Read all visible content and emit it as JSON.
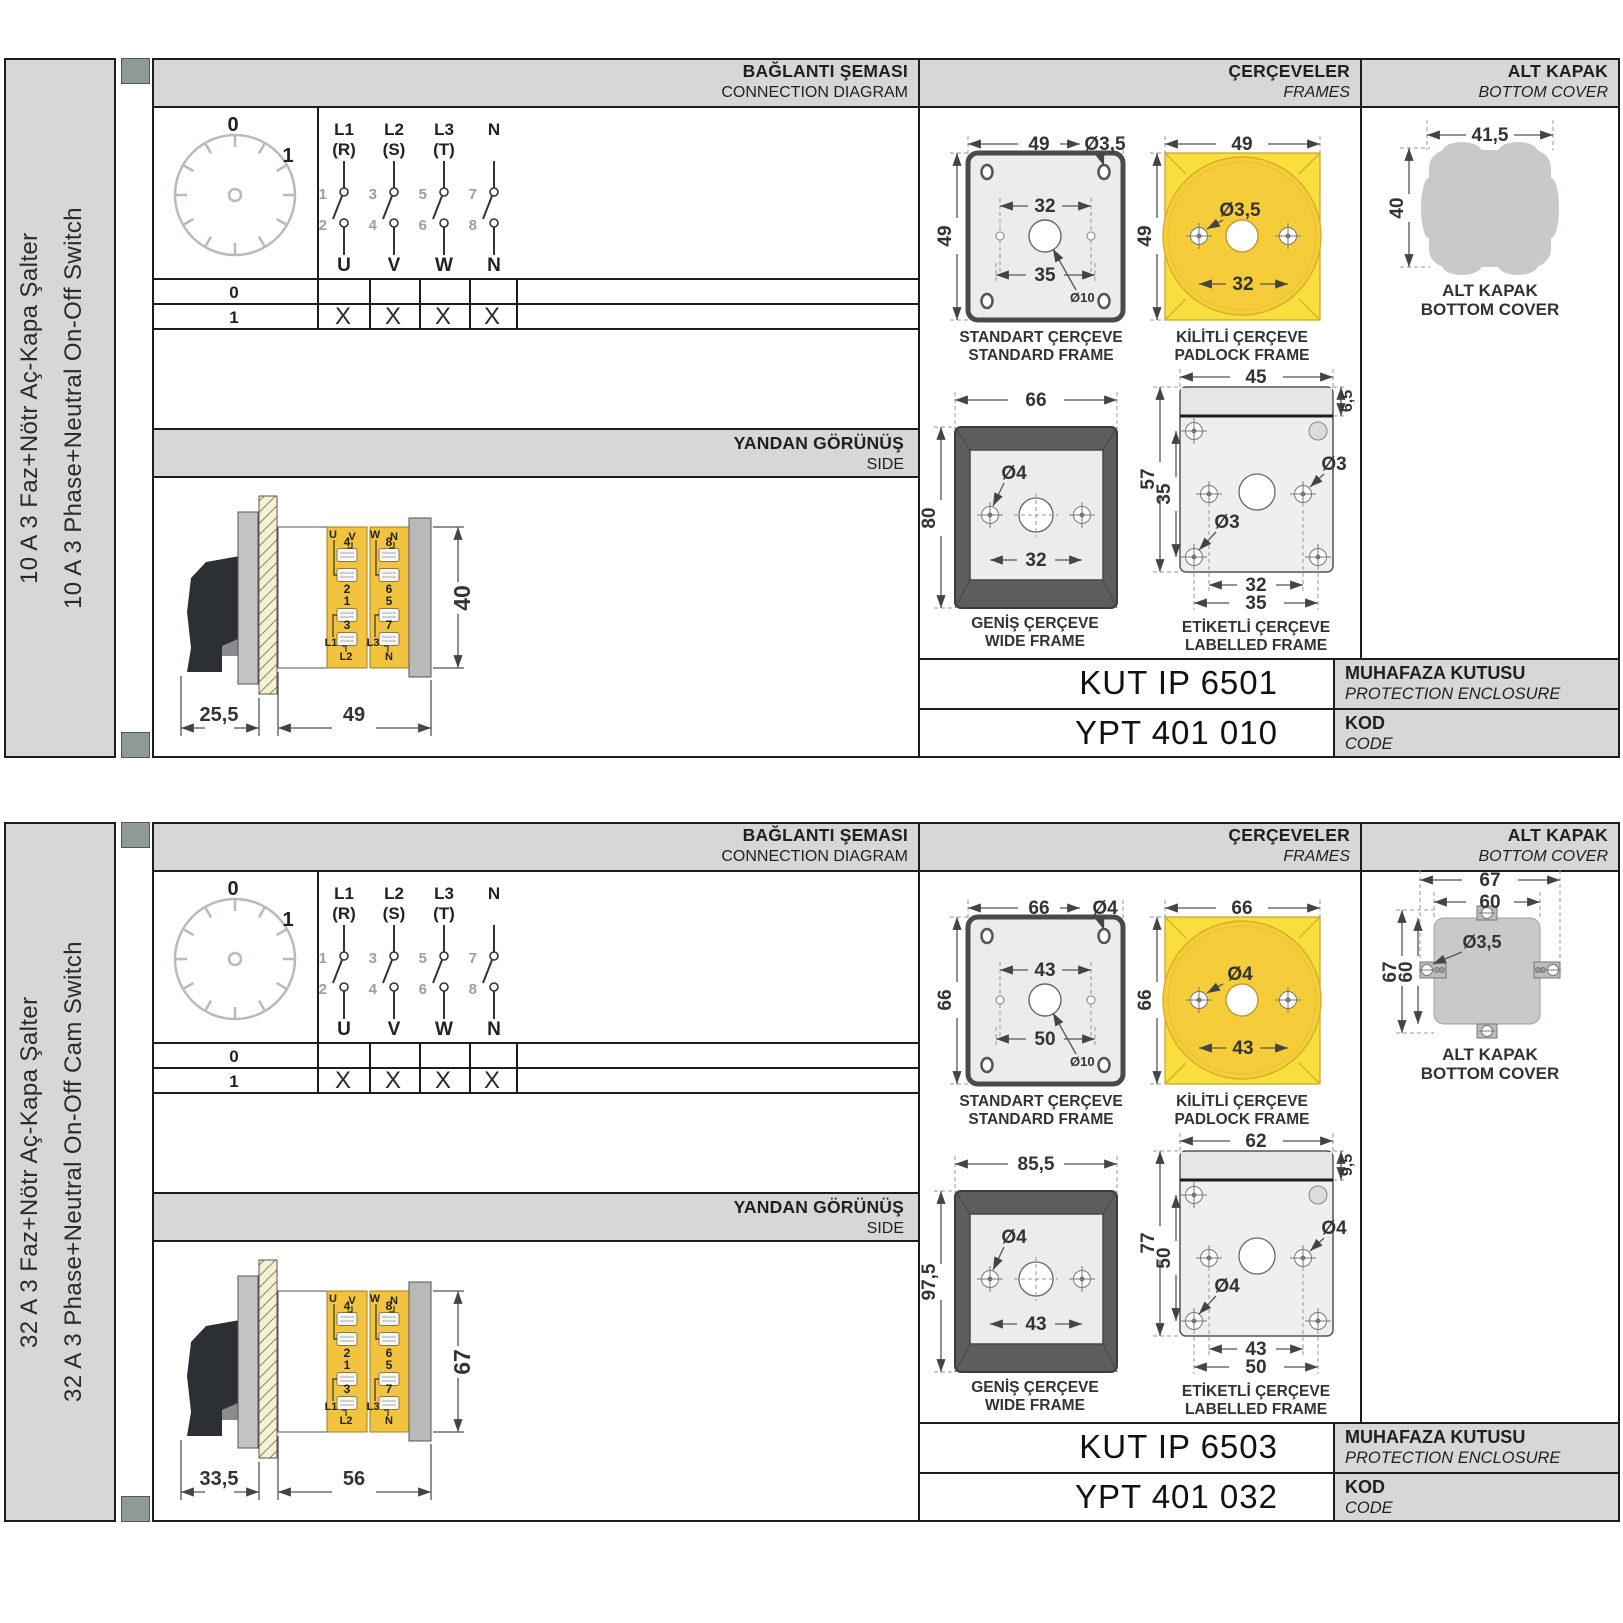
{
  "sections": [
    {
      "sidebar": {
        "tr": "10 A 3 Faz+Nötr Aç-Kapa Şalter",
        "en": "10 A 3 Phase+Neutral On-Off Switch"
      },
      "header": {
        "conn_tr": "BAĞLANTI ŞEMASI",
        "conn_en": "CONNECTION DIAGRAM",
        "frames_tr": "ÇERÇEVELER",
        "frames_en": "FRAMES",
        "cover_tr": "ALT KAPAK",
        "cover_en": "BOTTOM COVER"
      },
      "dial": {
        "pos0": "0",
        "pos1": "1"
      },
      "poles": [
        {
          "line1": "L1",
          "line2": "(R)",
          "n_in": "1",
          "n_out": "2",
          "out": "U"
        },
        {
          "line1": "L2",
          "line2": "(S)",
          "n_in": "3",
          "n_out": "4",
          "out": "V"
        },
        {
          "line1": "L3",
          "line2": "(T)",
          "n_in": "5",
          "n_out": "6",
          "out": "W"
        },
        {
          "line1": "N",
          "line2": "",
          "n_in": "7",
          "n_out": "8",
          "out": "N"
        }
      ],
      "table": {
        "row0": "0",
        "row1": "1",
        "marks": [
          "X",
          "X",
          "X",
          "X"
        ]
      },
      "side": {
        "title_tr": "YANDAN GÖRÜNÜŞ",
        "title_en": "SIDE",
        "dim_depth": "25,5",
        "dim_width": "49",
        "dim_height": "40",
        "tl1": "U",
        "tl2": "V",
        "tr1": "W",
        "tr2": "N",
        "bl1": "L1",
        "bl2": "L2",
        "br1": "L3",
        "br2": "N",
        "lt": [
          "4",
          "2",
          "1",
          "3"
        ],
        "rt": [
          "8",
          "6",
          "5",
          "7"
        ]
      },
      "frames": {
        "standard": {
          "tr": "STANDART ÇERÇEVE",
          "en": "STANDARD FRAME",
          "w": "49",
          "h": "49",
          "hole": "Ø3,5",
          "inner": "32",
          "chole": "Ø10",
          "bottom": "35"
        },
        "padlock": {
          "tr": "KİLİTLİ ÇERÇEVE",
          "en": "PADLOCK FRAME",
          "w": "49",
          "h": "49",
          "hole": "Ø3,5",
          "inner": "32"
        },
        "wide": {
          "tr": "GENİŞ ÇERÇEVE",
          "en": "WIDE FRAME",
          "w": "66",
          "h": "80",
          "hole": "Ø4",
          "inner": "32"
        },
        "labelled": {
          "tr": "ETİKETLİ ÇERÇEVE",
          "en": "LABELLED FRAME",
          "w": "45",
          "band": "6,5",
          "h": "57",
          "inner_h": "35",
          "hole_a": "Ø3",
          "hole_b": "Ø3",
          "bot_inner": "32",
          "bot_outer": "35"
        }
      },
      "cover": {
        "variant": "blob",
        "label_tr": "ALT KAPAK",
        "label_en": "BOTTOM COVER",
        "blob": {
          "w": "41,5",
          "h": "40"
        }
      },
      "codes": {
        "enclosure": "KUT IP 6501",
        "enclosure_tr": "MUHAFAZA KUTUSU",
        "enclosure_en": "PROTECTION ENCLOSURE",
        "code": "YPT 401 010",
        "code_tr": "KOD",
        "code_en": "CODE"
      }
    },
    {
      "sidebar": {
        "tr": "32 A 3 Faz+Nötr Aç-Kapa Şalter",
        "en": "32 A 3 Phase+Neutral On-Off Cam Switch"
      },
      "header": {
        "conn_tr": "BAĞLANTI ŞEMASI",
        "conn_en": "CONNECTION DIAGRAM",
        "frames_tr": "ÇERÇEVELER",
        "frames_en": "FRAMES",
        "cover_tr": "ALT KAPAK",
        "cover_en": "BOTTOM COVER"
      },
      "dial": {
        "pos0": "0",
        "pos1": "1"
      },
      "poles": [
        {
          "line1": "L1",
          "line2": "(R)",
          "n_in": "1",
          "n_out": "2",
          "out": "U"
        },
        {
          "line1": "L2",
          "line2": "(S)",
          "n_in": "3",
          "n_out": "4",
          "out": "V"
        },
        {
          "line1": "L3",
          "line2": "(T)",
          "n_in": "5",
          "n_out": "6",
          "out": "W"
        },
        {
          "line1": "N",
          "line2": "",
          "n_in": "7",
          "n_out": "8",
          "out": "N"
        }
      ],
      "table": {
        "row0": "0",
        "row1": "1",
        "marks": [
          "X",
          "X",
          "X",
          "X"
        ]
      },
      "side": {
        "title_tr": "YANDAN GÖRÜNÜŞ",
        "title_en": "SIDE",
        "dim_depth": "33,5",
        "dim_width": "56",
        "dim_height": "67",
        "tl1": "U",
        "tl2": "V",
        "tr1": "W",
        "tr2": "N",
        "bl1": "L1",
        "bl2": "L2",
        "br1": "L3",
        "br2": "N",
        "lt": [
          "4",
          "2",
          "1",
          "3"
        ],
        "rt": [
          "8",
          "6",
          "5",
          "7"
        ]
      },
      "frames": {
        "standard": {
          "tr": "STANDART ÇERÇEVE",
          "en": "STANDARD FRAME",
          "w": "66",
          "h": "66",
          "hole": "Ø4",
          "inner": "43",
          "chole": "Ø10",
          "bottom": "50"
        },
        "padlock": {
          "tr": "KİLİTLİ ÇERÇEVE",
          "en": "PADLOCK FRAME",
          "w": "66",
          "h": "66",
          "hole": "Ø4",
          "inner": "43"
        },
        "wide": {
          "tr": "GENİŞ ÇERÇEVE",
          "en": "WIDE FRAME",
          "w": "85,5",
          "h": "97,5",
          "hole": "Ø4",
          "inner": "43"
        },
        "labelled": {
          "tr": "ETİKETLİ ÇERÇEVE",
          "en": "LABELLED FRAME",
          "w": "62",
          "band": "9,5",
          "h": "77",
          "inner_h": "50",
          "hole_a": "Ø4",
          "hole_b": "Ø4",
          "bot_inner": "43",
          "bot_outer": "50"
        }
      },
      "cover": {
        "variant": "tabs",
        "label_tr": "ALT KAPAK",
        "label_en": "BOTTOM COVER",
        "tabs": {
          "w1": "67",
          "w2": "60",
          "h1": "67",
          "h2": "60",
          "hole": "Ø3,5"
        }
      },
      "codes": {
        "enclosure": "KUT IP 6503",
        "enclosure_tr": "MUHAFAZA KUTUSU",
        "enclosure_en": "PROTECTION ENCLOSURE",
        "code": "YPT 401 032",
        "code_tr": "KOD",
        "code_en": "CODE"
      }
    }
  ]
}
